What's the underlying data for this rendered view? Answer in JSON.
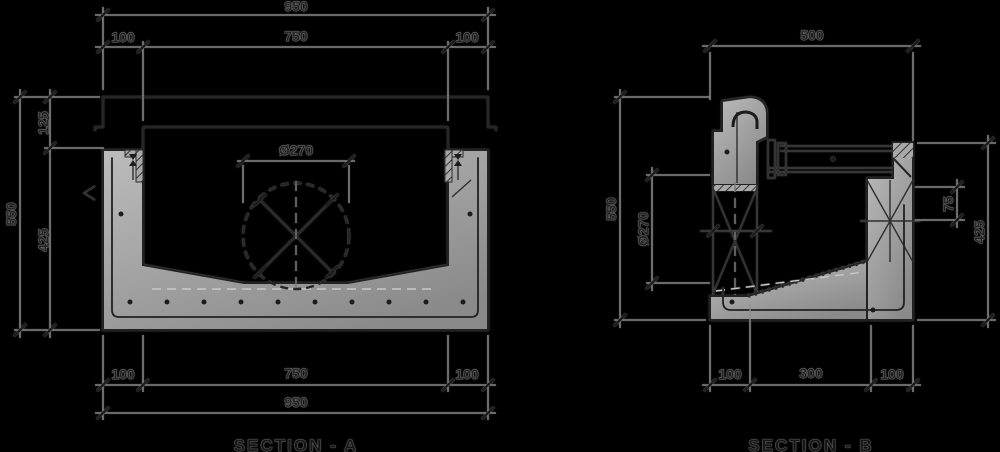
{
  "colors": {
    "background": "#000000",
    "dimension_line": "#8f8f8f",
    "ink": "#262626",
    "concrete_light": "#bcbcbc",
    "concrete_dark": "#8a8a8a"
  },
  "section_a": {
    "label": "SECTION - A",
    "dims": {
      "top_overall": "950",
      "top_wall_left": "100",
      "top_internal": "750",
      "top_wall_right": "100",
      "height_overall": "550",
      "rebate_depth": "125",
      "body_height": "425",
      "pipe_diameter": "Ø270",
      "bottom_wall_left": "100",
      "bottom_internal": "750",
      "bottom_wall_right": "100",
      "bottom_overall": "950"
    }
  },
  "section_b": {
    "label": "SECTION - B",
    "dims": {
      "top_overall": "500",
      "height_overall": "550",
      "pipe_diameter": "Ø270",
      "seat_depth": "75",
      "outlet_height": "425",
      "bottom_wall_left": "100",
      "bottom_internal": "300",
      "bottom_wall_right": "100"
    }
  }
}
